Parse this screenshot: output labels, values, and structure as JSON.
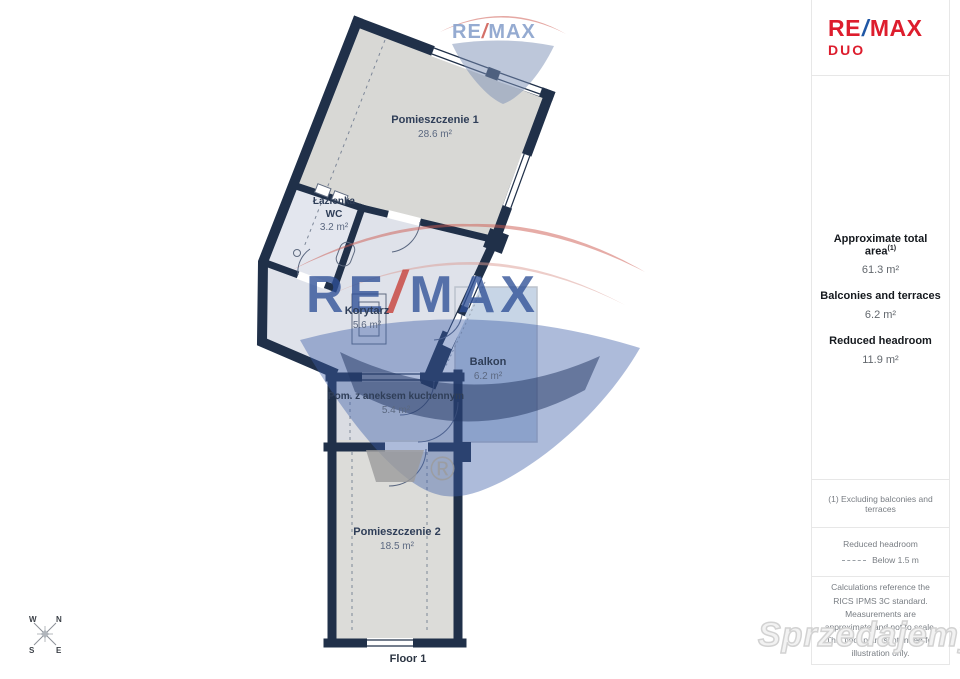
{
  "logo": {
    "re": "RE",
    "slash": "/",
    "max": "MAX",
    "duo": "DUO"
  },
  "sidebar": {
    "stats": [
      {
        "label": "Approximate total area",
        "sup": "(1)",
        "value": "61.3 m²"
      },
      {
        "label": "Balconies and terraces",
        "sup": "",
        "value": "6.2 m²"
      },
      {
        "label": "Reduced headroom",
        "sup": "",
        "value": "11.9 m²"
      }
    ],
    "note1": "(1) Excluding balconies and terraces",
    "legend_title": "Reduced headroom",
    "legend_value": "Below 1.5 m",
    "disclaimer": "Calculations reference the RICS IPMS 3C standard. Measurements are approximate and not to scale. This floor plan is intended for illustration only."
  },
  "plan": {
    "floor_label": "Floor 1",
    "rooms": {
      "pom1": {
        "name": "Pomieszczenie 1",
        "area": "28.6 m²"
      },
      "lazienka": {
        "name": "Łazienka",
        "name2": "WC",
        "area": "3.2 m²"
      },
      "korytarz": {
        "name": "Korytarz",
        "area": "5.6 m²"
      },
      "balkon": {
        "name": "Balkon",
        "area": "6.2 m²"
      },
      "kuchnia": {
        "name": "Pom. z aneksem kuchennym",
        "area": "5.4 m²"
      },
      "pom2": {
        "name": "Pomieszczenie 2",
        "area": "18.5 m²"
      }
    },
    "compass": {
      "n": "N",
      "e": "E",
      "s": "S",
      "w": "W"
    }
  },
  "watermarks": {
    "re": "RE",
    "slash": "/",
    "max": "MAX",
    "registered": "®",
    "portal_name": "Sprzedajemy",
    "portal_tld": ".pl"
  },
  "colors": {
    "wall": "#203049",
    "remax_red": "#dd1d2d",
    "remax_blue": "#1f57a5",
    "room_gray": "#d8d8d5",
    "balcony_blue": "#c7d5e6"
  }
}
